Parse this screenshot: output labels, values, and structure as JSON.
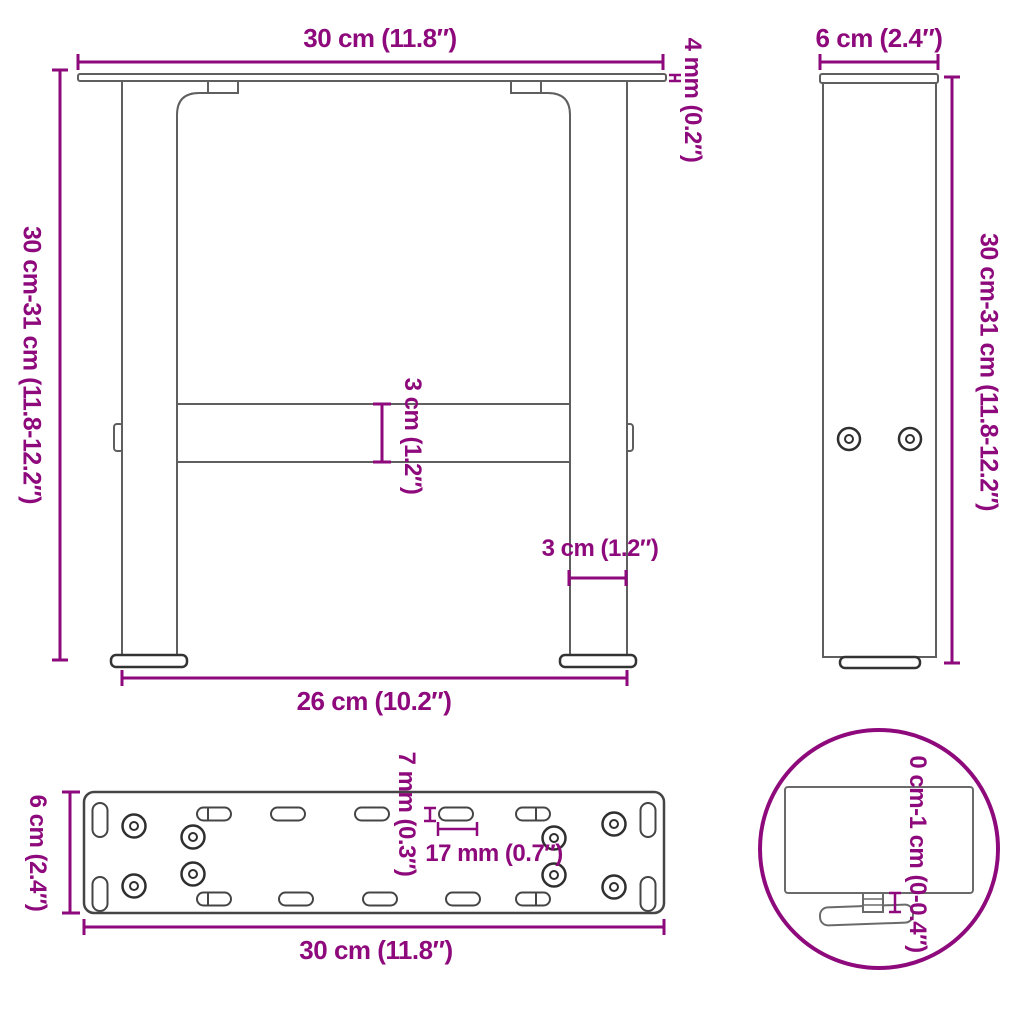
{
  "title": "Table legs dimension diagram",
  "accent_color": "#8E0A7C",
  "line_color": "#5f5f5f",
  "labels": {
    "front_width_top": "30 cm (11.8″)",
    "front_plate_thickness": "4 mm (0.2″)",
    "front_height": "30 cm-31 cm (11.8-12.2″)",
    "front_crossbar_height": "3 cm (1.2″)",
    "front_leg_width": "3 cm (1.2″)",
    "front_width_bottom": "26 cm (10.2″)",
    "side_depth": "6 cm (2.4″)",
    "side_height": "30 cm-31 cm (11.8-12.2″)",
    "top_depth": "6 cm (2.4″)",
    "top_slot_width": "7 mm (0.3″)",
    "top_hole_spacing": "17 mm (0.7″)",
    "top_width": "30 cm (11.8″)",
    "detail_adjustment_range": "0 cm-1 cm (0-0.4″)"
  },
  "views": [
    {
      "id": "front",
      "description": "front view of table leg frame"
    },
    {
      "id": "side",
      "description": "side view of leg"
    },
    {
      "id": "top",
      "description": "top view of mounting plate"
    },
    {
      "id": "detail",
      "description": "detail circle of adjustable foot"
    }
  ]
}
